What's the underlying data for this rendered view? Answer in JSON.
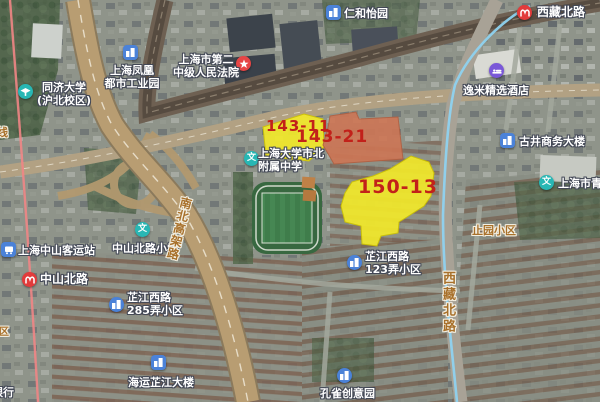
{
  "map": {
    "description": "satellite map of Zhabei, Shanghai with highlighted land parcels"
  },
  "parcels": [
    {
      "code": "143-11"
    },
    {
      "code": "143-21"
    },
    {
      "code": "150-13"
    }
  ],
  "road_labels": {
    "elevated": "南北高架路",
    "xizang_vertical": "西藏北路"
  },
  "area_labels": {
    "zhiyuan": "止园小区"
  },
  "edge_fragments": {
    "rail_line": "线",
    "district": "区",
    "bank": "银行"
  },
  "stations": [
    {
      "name": "西藏北路"
    },
    {
      "name": "中山北路"
    }
  ],
  "pois": [
    {
      "label": "仁和怡园"
    },
    {
      "line1": "上海市第二",
      "line2": "中级人民法院"
    },
    {
      "line1": "同济大学",
      "line2": "(沪北校区)"
    },
    {
      "line1": "上海凤凰",
      "line2": "都市工业园"
    },
    {
      "label": "逸米精选酒店"
    },
    {
      "label": "古井商务大楼"
    },
    {
      "label": "上海市青"
    },
    {
      "line1": "上海大学市北",
      "line2": "附属中学"
    },
    {
      "label": "中山北路小学"
    },
    {
      "label": "上海中山客运站"
    },
    {
      "line1": "芷江西路",
      "line2": "285弄小区"
    },
    {
      "label": "海运芷江大楼"
    },
    {
      "line1": "芷江西路",
      "line2": "123弄小区"
    },
    {
      "label": "孔雀创意园"
    }
  ],
  "icons": {
    "school_glyph": "文"
  },
  "colors": {
    "parcel_fill": "#f2e92a",
    "parcel_143_21_fill": "#ce7655",
    "parcel_label": "#c2211a",
    "road_label": "#a8702a",
    "metro_icon": "#e23b3b",
    "metro_line_red": "#ef8585",
    "metro_line_blue": "#8ed2ef",
    "poi_blue": "#4b82d8",
    "poi_teal": "#28b7b4",
    "poi_purple": "#7a58d8"
  }
}
